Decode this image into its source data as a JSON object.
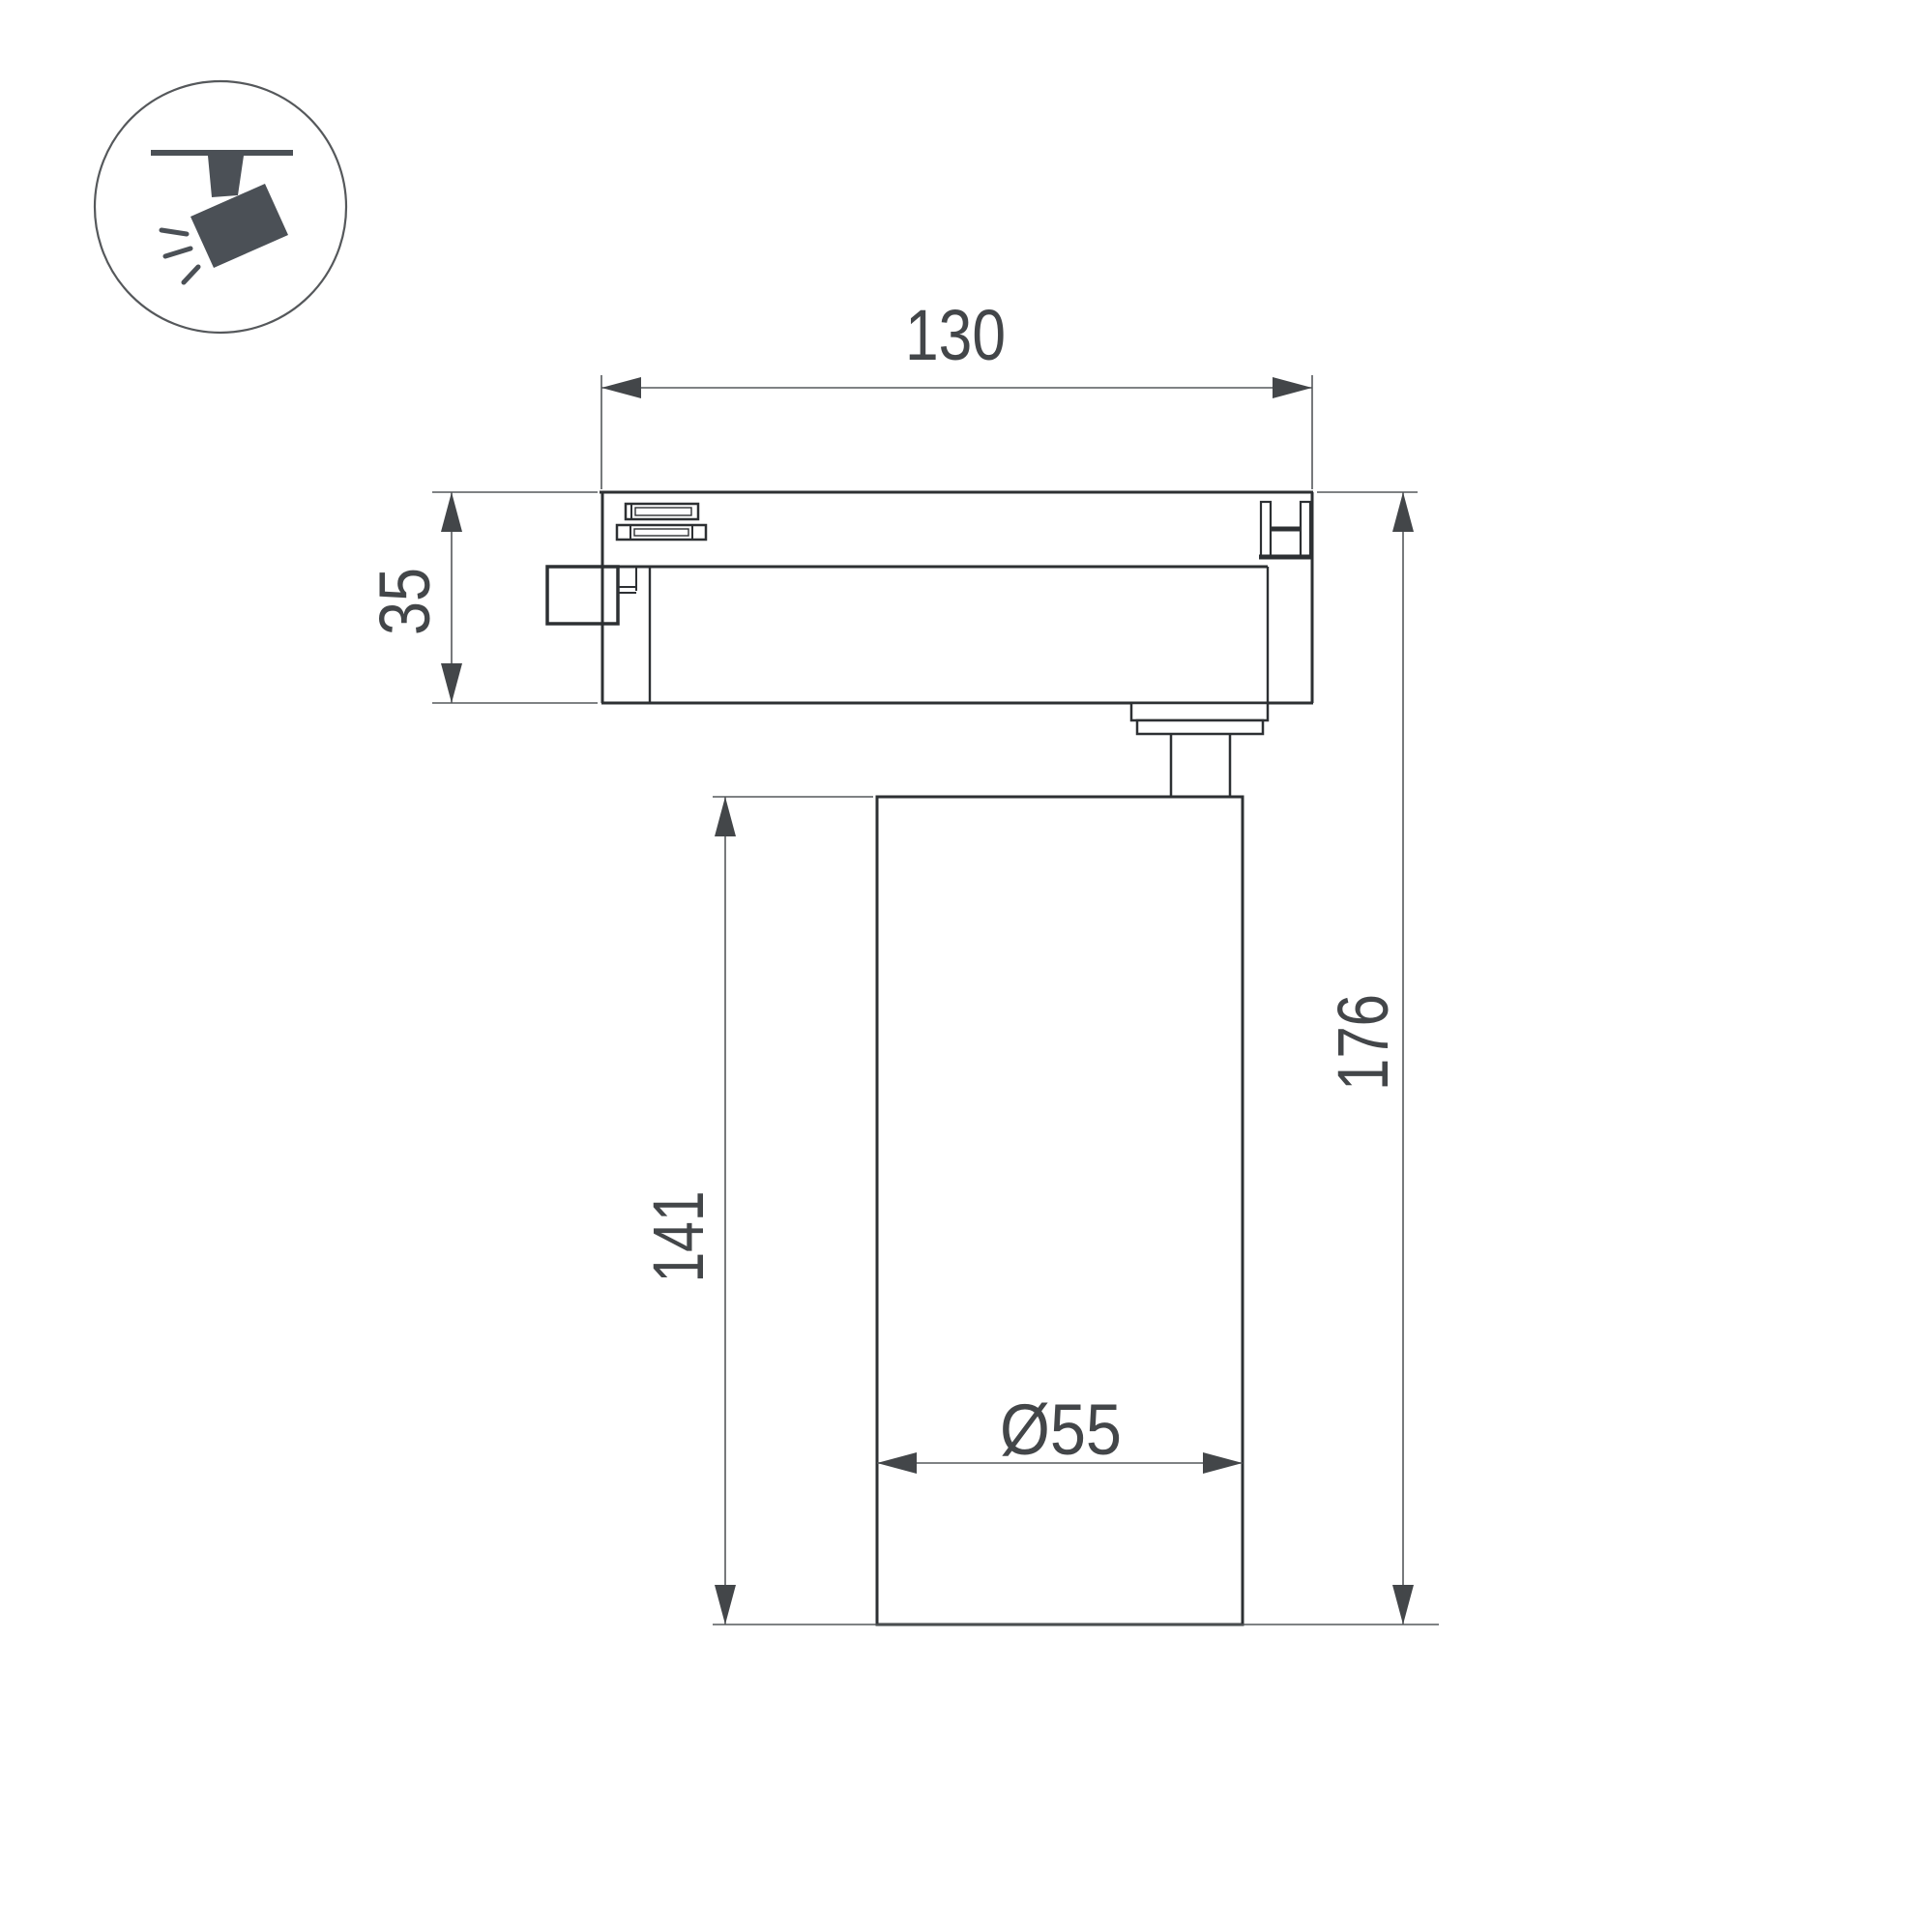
{
  "meta": {
    "type": "technical-dimension-drawing",
    "subject": "track-mounted spotlight, side view"
  },
  "icon": {
    "label": "track-spotlight-icon"
  },
  "dimensions": {
    "adapter_length": "130",
    "adapter_height": "35",
    "body_height": "141",
    "overall_height": "176",
    "body_diameter": "Ø55"
  },
  "colors": {
    "outline": "#2d3033",
    "dimension_lines": "#55585b",
    "dimension_text": "#434649",
    "icon": "#4b5056",
    "background": "#ffffff"
  }
}
